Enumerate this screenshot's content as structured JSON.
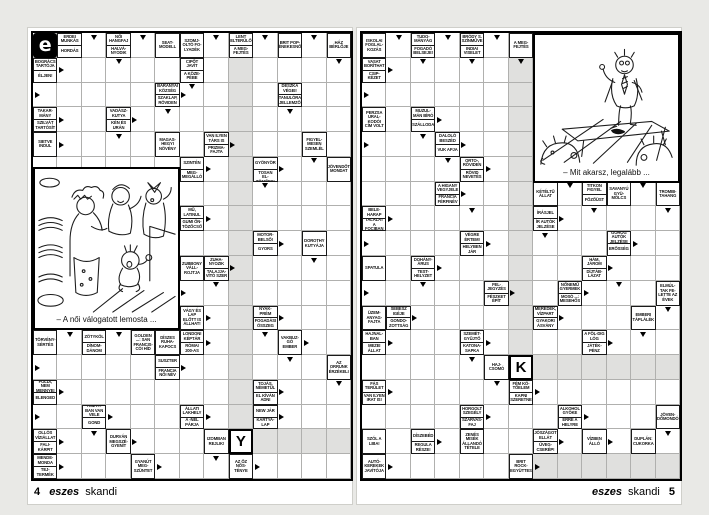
{
  "spread": {
    "background": "#e9e9e6",
    "page_color": "#ffffff",
    "grid_line_color": "#b0b0ae",
    "solution_shade_color": "#e0e0de",
    "ink_color": "#000000"
  },
  "left_page": {
    "logo_letter": "e",
    "footer": {
      "page_number": "4",
      "brand": "eszes",
      "series": "skandi"
    },
    "cartoon_caption": "– A női válogatott lemosta ...",
    "grid": {
      "cols": 13,
      "rows": 18
    },
    "shaded": [
      {
        "c0": 8,
        "c1": 8,
        "r0": 1,
        "r1": 15
      },
      {
        "c0": 9,
        "c1": 12,
        "r0": 16,
        "r1": 16
      }
    ],
    "letters": [
      {
        "c": 8,
        "r": 16,
        "ch": "Y"
      }
    ],
    "clues": [
      {
        "c": 1,
        "r": 0,
        "t": [
          "ERDEI MUNKÁS",
          "HORDÁS"
        ]
      },
      {
        "c": 3,
        "r": 0,
        "t": [
          "NŐI HANGFAJ",
          "HALVÁ-NYODIK"
        ]
      },
      {
        "c": 5,
        "r": 0,
        "t": [
          "SEAT-MODELL"
        ]
      },
      {
        "c": 6,
        "r": 0,
        "t": [
          "SZOMJ-OLTÓ FO-LYADÉK"
        ]
      },
      {
        "c": 8,
        "r": 0,
        "t": [
          "LENT ELTERÜLŐ",
          "A MEG-FEJTÉS"
        ]
      },
      {
        "c": 10,
        "r": 0,
        "t": [
          "BRIT POP-ÉNEKESNŐ"
        ]
      },
      {
        "c": 12,
        "r": 0,
        "t": [
          "HÁZ BÉRLŐJE"
        ]
      },
      {
        "c": 0,
        "r": 1,
        "t": [
          "BOGRÁCS TARTÓJA",
          "ÉLJEN!"
        ]
      },
      {
        "c": 6,
        "r": 1,
        "t": [
          "CIPŐT JAVÍT",
          "A KÖZE-PÉBE"
        ]
      },
      {
        "c": 5,
        "r": 2,
        "t": [
          "BARANYAI KÖZSÉG",
          "SZAKLAP, RÖVIDEN"
        ]
      },
      {
        "c": 10,
        "r": 2,
        "t": [
          "DESZKA VÉGEI!",
          "TANULÓRA JELLEMZŐ"
        ]
      },
      {
        "c": 0,
        "r": 3,
        "t": [
          "TAKAR-MÁNY",
          "SZILVÁT TARTÓSÍT"
        ]
      },
      {
        "c": 3,
        "r": 3,
        "t": [
          "VADÁSZ-KUTYA",
          "KÉN ÉS URÁN"
        ]
      },
      {
        "c": 0,
        "r": 4,
        "t": [
          "SIETVE INDUL"
        ]
      },
      {
        "c": 5,
        "r": 4,
        "t": [
          "MAGAS-HEGYI NÖVÉNY"
        ]
      },
      {
        "c": 7,
        "r": 4,
        "t": [
          "VAN ILYEN TÁRS IS",
          "PRIZMA-FAJTA"
        ]
      },
      {
        "c": 11,
        "r": 4,
        "t": [
          "FIGYEL-MESEN SZEMLÉL"
        ]
      },
      {
        "c": 6,
        "r": 5,
        "t": [
          "SZINTÉN",
          "MEG-MEGÁLLÓ"
        ]
      },
      {
        "c": 9,
        "r": 5,
        "t": [
          "GYÖNYÖR",
          "FOKOZA-TOSAN EL-TÖMŐDIK"
        ]
      },
      {
        "c": 12,
        "r": 5,
        "t": [
          "JÖVENDŐT MONDAT"
        ]
      },
      {
        "c": 6,
        "r": 7,
        "t": [
          "MŰ, LATINUL",
          "GUMI ÖN-TÖZŐCSŐ"
        ]
      },
      {
        "c": 9,
        "r": 8,
        "t": [
          "MOTOR-BELSŐ!",
          "GYORS"
        ]
      },
      {
        "c": 11,
        "r": 8,
        "t": [
          "DOROTHY KUTYÁJA"
        ]
      },
      {
        "c": 6,
        "r": 9,
        "t": [
          "ZUBBONY VÁLL-ROJTJA"
        ]
      },
      {
        "c": 7,
        "r": 9,
        "t": [
          "ZUHA-NYOZIK",
          "TALAJJA-VÍTÓ SZER"
        ]
      },
      {
        "c": 6,
        "r": 11,
        "t": [
          "VÁGY ÉS LAP ELŐTT IS ÁLLHAT!"
        ]
      },
      {
        "c": 9,
        "r": 11,
        "t": [
          "NYAK-PRÉM",
          "FOGADÁSI ÖSSZEG"
        ]
      },
      {
        "c": 0,
        "r": 12,
        "t": [
          "TÖRVÉNY-SÉRTÉS"
        ]
      },
      {
        "c": 2,
        "r": 12,
        "t": [
          "ZÖTYKÖL",
          "DÍNOM-DÁNOM"
        ]
      },
      {
        "c": 4,
        "r": 12,
        "t": [
          "GOLDEN ...: SAN FRANCIS-CÓI HÍD"
        ]
      },
      {
        "c": 5,
        "r": 12,
        "t": [
          "DÍSZES RUHA-KAPOCS"
        ]
      },
      {
        "c": 6,
        "r": 12,
        "t": [
          "LONDONI KÉPTÁR",
          "RÓMAI 200-AS"
        ]
      },
      {
        "c": 10,
        "r": 12,
        "t": [
          "VAKBUZ-GÓ EMBER"
        ]
      },
      {
        "c": 5,
        "r": 13,
        "t": [
          "SUSZTER",
          "FRANCIA NŐI NÉV"
        ]
      },
      {
        "c": 12,
        "r": 13,
        "t": [
          "AZ ORRUNK ÉRZÉKELI"
        ]
      },
      {
        "c": 0,
        "r": 14,
        "t": [
          "FÖLDI, NEM MENNYEI",
          "ELENGED"
        ]
      },
      {
        "c": 9,
        "r": 14,
        "t": [
          "TOJÁS, NÉMETÜL",
          "EL KÍVÁN ADNI"
        ]
      },
      {
        "c": 2,
        "r": 15,
        "t": [
          "TISZTÁ-BAN VAN VELE",
          "GOND"
        ]
      },
      {
        "c": 6,
        "r": 15,
        "t": [
          "ÁLLATI LAKHELY",
          "A -NÉL PÁRJA"
        ]
      },
      {
        "c": 9,
        "r": 15,
        "t": [
          "NEW JÁR",
          "KÁRTYA-LAP"
        ]
      },
      {
        "c": 0,
        "r": 16,
        "t": [
          "OLLÓS VÍZIÁLLAT",
          "FALI-KÁRPIT"
        ]
      },
      {
        "c": 3,
        "r": 16,
        "t": [
          "DURVÁN MEGSZÉ-GYENÍT"
        ]
      },
      {
        "c": 7,
        "r": 16,
        "t": [
          "IZOMBAN REJLIK!"
        ]
      },
      {
        "c": 0,
        "r": 17,
        "t": [
          "MENDE-MONDA",
          "TEJ-TERMÉK"
        ]
      },
      {
        "c": 4,
        "r": 17,
        "t": [
          "GYANÚT MEG-SZÜNTET"
        ]
      },
      {
        "c": 8,
        "r": 17,
        "t": [
          "AZ ŐZ NŐS-TÉNYE"
        ]
      }
    ],
    "arrows": [
      {
        "c": 2,
        "r": 0,
        "d": "down"
      },
      {
        "c": 4,
        "r": 0,
        "d": "down"
      },
      {
        "c": 7,
        "r": 0,
        "d": "down"
      },
      {
        "c": 9,
        "r": 0,
        "d": "down"
      },
      {
        "c": 11,
        "r": 0,
        "d": "down"
      },
      {
        "c": 3,
        "r": 1,
        "d": "down"
      },
      {
        "c": 12,
        "r": 1,
        "d": "down"
      },
      {
        "c": 1,
        "r": 1,
        "d": "right"
      },
      {
        "c": 0,
        "r": 2,
        "d": "right"
      },
      {
        "c": 6,
        "r": 2,
        "d": "right"
      },
      {
        "c": 6,
        "r": 2,
        "d": "down"
      },
      {
        "c": 1,
        "r": 3,
        "d": "right"
      },
      {
        "c": 4,
        "r": 3,
        "d": "right"
      },
      {
        "c": 5,
        "r": 3,
        "d": "down"
      },
      {
        "c": 10,
        "r": 3,
        "d": "down"
      },
      {
        "c": 1,
        "r": 4,
        "d": "right"
      },
      {
        "c": 3,
        "r": 4,
        "d": "down"
      },
      {
        "c": 8,
        "r": 4,
        "d": "right"
      },
      {
        "c": 7,
        "r": 5,
        "d": "right"
      },
      {
        "c": 10,
        "r": 5,
        "d": "right"
      },
      {
        "c": 11,
        "r": 5,
        "d": "down"
      },
      {
        "c": 9,
        "r": 6,
        "d": "down"
      },
      {
        "c": 7,
        "r": 7,
        "d": "right"
      },
      {
        "c": 10,
        "r": 8,
        "d": "right"
      },
      {
        "c": 8,
        "r": 9,
        "d": "right"
      },
      {
        "c": 11,
        "r": 9,
        "d": "down"
      },
      {
        "c": 6,
        "r": 10,
        "d": "right"
      },
      {
        "c": 7,
        "r": 10,
        "d": "down"
      },
      {
        "c": 7,
        "r": 11,
        "d": "right"
      },
      {
        "c": 10,
        "r": 11,
        "d": "right"
      },
      {
        "c": 1,
        "r": 12,
        "d": "down"
      },
      {
        "c": 3,
        "r": 12,
        "d": "down"
      },
      {
        "c": 7,
        "r": 12,
        "d": "right"
      },
      {
        "c": 9,
        "r": 12,
        "d": "down"
      },
      {
        "c": 11,
        "r": 12,
        "d": "right"
      },
      {
        "c": 0,
        "r": 13,
        "d": "right"
      },
      {
        "c": 6,
        "r": 13,
        "d": "right"
      },
      {
        "c": 10,
        "r": 13,
        "d": "down"
      },
      {
        "c": 1,
        "r": 14,
        "d": "right"
      },
      {
        "c": 10,
        "r": 14,
        "d": "right"
      },
      {
        "c": 12,
        "r": 14,
        "d": "down"
      },
      {
        "c": 0,
        "r": 15,
        "d": "right"
      },
      {
        "c": 3,
        "r": 15,
        "d": "right"
      },
      {
        "c": 7,
        "r": 15,
        "d": "right"
      },
      {
        "c": 10,
        "r": 15,
        "d": "right"
      },
      {
        "c": 1,
        "r": 16,
        "d": "right"
      },
      {
        "c": 2,
        "r": 16,
        "d": "down"
      },
      {
        "c": 4,
        "r": 16,
        "d": "right"
      },
      {
        "c": 1,
        "r": 17,
        "d": "right"
      },
      {
        "c": 5,
        "r": 17,
        "d": "right"
      },
      {
        "c": 7,
        "r": 17,
        "d": "down"
      },
      {
        "c": 9,
        "r": 17,
        "d": "right"
      }
    ]
  },
  "right_page": {
    "footer": {
      "page_number": "5",
      "brand": "eszes",
      "series": "skandi"
    },
    "cartoon_caption": "– Mit akarsz, legalább ...",
    "grid": {
      "cols": 13,
      "rows": 18
    },
    "shaded": [
      {
        "c0": 6,
        "c1": 6,
        "r0": 1,
        "r1": 12
      },
      {
        "c0": 7,
        "c1": 12,
        "r0": 13,
        "r1": 13
      },
      {
        "c0": 7,
        "c1": 12,
        "r0": 17,
        "r1": 17
      }
    ],
    "letters": [
      {
        "c": 6,
        "r": 13,
        "ch": "K"
      }
    ],
    "clues": [
      {
        "c": 0,
        "r": 0,
        "t": [
          "ISKOLAI FOGLAL-KOZÁS"
        ]
      },
      {
        "c": 2,
        "r": 0,
        "t": [
          "TUDO-MÁNYÁG",
          "FOGADÓ BELSEJE!"
        ]
      },
      {
        "c": 4,
        "r": 0,
        "t": [
          "BRÓDY S. SZÍNMŰVE",
          "INDIAI VISELET"
        ]
      },
      {
        "c": 6,
        "r": 0,
        "t": [
          "A MEG-FEJTÉS"
        ]
      },
      {
        "c": 0,
        "r": 1,
        "t": [
          "VASAT BORÍTHAT",
          "CSIP-KÉZET"
        ]
      },
      {
        "c": 0,
        "r": 3,
        "t": [
          "PERZSA URAL-KODÓI CÍM VOLT"
        ]
      },
      {
        "c": 2,
        "r": 3,
        "t": [
          "MUZUL-MÁN BÍRÓ",
          "SZÁLLODA"
        ]
      },
      {
        "c": 3,
        "r": 4,
        "t": [
          "DALOLÓ BESZÉD",
          "VUK APJA"
        ]
      },
      {
        "c": 4,
        "r": 5,
        "t": [
          "ORTO-, RÖVIDEN",
          "RÖVID NEVETÉS"
        ]
      },
      {
        "c": 3,
        "r": 6,
        "t": [
          "A HIGANY VEGYJELE",
          "FRANCIA FÉRFINÉV"
        ]
      },
      {
        "c": 7,
        "r": 6,
        "t": [
          "KÉTÉLTŰ ÁLLAT"
        ]
      },
      {
        "c": 9,
        "r": 6,
        "t": [
          "TITKON FIGYEL",
          "FŐZŐÜST"
        ]
      },
      {
        "c": 10,
        "r": 6,
        "t": [
          "SAVANYÚ GYÜ-MÖLCS"
        ]
      },
      {
        "c": 12,
        "r": 6,
        "t": [
          "TROMBI-TAHANG"
        ]
      },
      {
        "c": 0,
        "r": 7,
        "t": [
          "BELE-HARAP",
          "TALÁLAT A FOCIBAN"
        ]
      },
      {
        "c": 7,
        "r": 7,
        "t": [
          "ÍRÁSJEL",
          "ÍR AUTÓK JELZÉSE"
        ]
      },
      {
        "c": 4,
        "r": 8,
        "t": [
          "VÉGRE ÉRTEM!",
          "HELYBEN JÁR"
        ]
      },
      {
        "c": 10,
        "r": 8,
        "t": [
          "GÖRÖG AUTÓK JELZÉSE",
          "ERŐSSÉG"
        ]
      },
      {
        "c": 0,
        "r": 9,
        "t": [
          "SPATULA"
        ]
      },
      {
        "c": 2,
        "r": 9,
        "t": [
          "DOHÁNY-ÁRUS",
          "TEST-HELYZET"
        ]
      },
      {
        "c": 9,
        "r": 9,
        "t": [
          "HÁM, JÁROM",
          "DÍJTÁB-LÁZAT"
        ]
      },
      {
        "c": 5,
        "r": 10,
        "t": [
          "FEL-JEGYZÉS",
          "FÉSZKET ÉPÍT"
        ]
      },
      {
        "c": 8,
        "r": 10,
        "t": [
          "NŐNEMŰ GYERMEK",
          "MOSÓ ...: MESEHŐS"
        ]
      },
      {
        "c": 12,
        "r": 10,
        "t": [
          "ELMÚL-TAK FE-LETTE AZ ÉVEK"
        ]
      },
      {
        "c": 0,
        "r": 11,
        "t": [
          "ÜZEM-ANYAG-FAJTA"
        ]
      },
      {
        "c": 1,
        "r": 11,
        "t": [
          "SEBÉSZ IGÉJE",
          "GONDO-ZOTTSÁG"
        ]
      },
      {
        "c": 7,
        "r": 11,
        "t": [
          "MEREDEK, VÍZPART",
          "GYAKORI ÁSVÁNY"
        ]
      },
      {
        "c": 11,
        "r": 11,
        "t": [
          "EMBERI TÁPLÁLÉK"
        ]
      },
      {
        "c": 0,
        "r": 12,
        "t": [
          "HAJNAL-BAN",
          "MEZEI ÁLLAT"
        ]
      },
      {
        "c": 4,
        "r": 12,
        "t": [
          "SZEMÉT-GYŰJTŐ",
          "KATONA-SAPKA"
        ]
      },
      {
        "c": 9,
        "r": 12,
        "t": [
          "A FÖL-DIG LÓG",
          "JÁTÉK-PÉNZ"
        ]
      },
      {
        "c": 5,
        "r": 13,
        "t": [
          "HAJ-CSOMÓ"
        ]
      },
      {
        "c": 0,
        "r": 14,
        "t": [
          "FÁS TERÜLET",
          "VAN ILYEN IRAT IS!"
        ]
      },
      {
        "c": 6,
        "r": 14,
        "t": [
          "FÉM KÖ-TŐELEM",
          "KAPNI SZERETNE"
        ]
      },
      {
        "c": 4,
        "r": 15,
        "t": [
          "HORGOLT SZEGÉLY",
          "SZARVAS-FAJ"
        ]
      },
      {
        "c": 8,
        "r": 15,
        "t": [
          "ALKOHOL GYÖKE",
          "ERRE A HELYRE"
        ]
      },
      {
        "c": 12,
        "r": 15,
        "t": [
          "JÖVEN-DŐMONDÓ"
        ]
      },
      {
        "c": 0,
        "r": 16,
        "t": [
          "SZÓL A LIBA!"
        ]
      },
      {
        "c": 2,
        "r": 16,
        "t": [
          "DÍSZEBÉD",
          "REGULA RÉSZE!"
        ]
      },
      {
        "c": 4,
        "r": 16,
        "t": [
          "ZENÉS MISÉK ÁLLANDÓ TÉTELE"
        ]
      },
      {
        "c": 7,
        "r": 16,
        "t": [
          "JÓSZÁGOT ELLÁT",
          "ÜVEG-CSERÉP!"
        ]
      },
      {
        "c": 9,
        "r": 16,
        "t": [
          "VÍZBEN ÁLLÓ"
        ]
      },
      {
        "c": 11,
        "r": 16,
        "t": [
          "DUPLÁN: CUKORKA"
        ]
      },
      {
        "c": 0,
        "r": 17,
        "t": [
          "AUTÓ-KEREKEK JAVÍTÓJA"
        ]
      },
      {
        "c": 6,
        "r": 17,
        "t": [
          "BRIT ROCK-EGYÜTTES"
        ]
      }
    ],
    "arrows": [
      {
        "c": 1,
        "r": 0,
        "d": "down"
      },
      {
        "c": 3,
        "r": 0,
        "d": "down"
      },
      {
        "c": 5,
        "r": 0,
        "d": "down"
      },
      {
        "c": 1,
        "r": 1,
        "d": "right"
      },
      {
        "c": 2,
        "r": 1,
        "d": "down"
      },
      {
        "c": 4,
        "r": 1,
        "d": "down"
      },
      {
        "c": 6,
        "r": 1,
        "d": "down"
      },
      {
        "c": 0,
        "r": 2,
        "d": "right"
      },
      {
        "c": 3,
        "r": 3,
        "d": "right"
      },
      {
        "c": 0,
        "r": 4,
        "d": "right"
      },
      {
        "c": 2,
        "r": 4,
        "d": "down"
      },
      {
        "c": 4,
        "r": 4,
        "d": "right"
      },
      {
        "c": 3,
        "r": 5,
        "d": "down"
      },
      {
        "c": 5,
        "r": 5,
        "d": "right"
      },
      {
        "c": 4,
        "r": 6,
        "d": "right"
      },
      {
        "c": 8,
        "r": 6,
        "d": "down"
      },
      {
        "c": 11,
        "r": 6,
        "d": "down"
      },
      {
        "c": 1,
        "r": 7,
        "d": "right"
      },
      {
        "c": 4,
        "r": 7,
        "d": "down"
      },
      {
        "c": 8,
        "r": 7,
        "d": "right"
      },
      {
        "c": 9,
        "r": 7,
        "d": "down"
      },
      {
        "c": 12,
        "r": 7,
        "d": "down"
      },
      {
        "c": 0,
        "r": 8,
        "d": "right"
      },
      {
        "c": 5,
        "r": 8,
        "d": "right"
      },
      {
        "c": 7,
        "r": 8,
        "d": "down"
      },
      {
        "c": 11,
        "r": 8,
        "d": "right"
      },
      {
        "c": 3,
        "r": 9,
        "d": "right"
      },
      {
        "c": 10,
        "r": 9,
        "d": "right"
      },
      {
        "c": 0,
        "r": 10,
        "d": "right"
      },
      {
        "c": 2,
        "r": 10,
        "d": "down"
      },
      {
        "c": 6,
        "r": 10,
        "d": "right"
      },
      {
        "c": 9,
        "r": 10,
        "d": "right"
      },
      {
        "c": 10,
        "r": 10,
        "d": "down"
      },
      {
        "c": 2,
        "r": 11,
        "d": "right"
      },
      {
        "c": 8,
        "r": 11,
        "d": "right"
      },
      {
        "c": 12,
        "r": 11,
        "d": "down"
      },
      {
        "c": 1,
        "r": 12,
        "d": "right"
      },
      {
        "c": 5,
        "r": 12,
        "d": "right"
      },
      {
        "c": 10,
        "r": 12,
        "d": "right"
      },
      {
        "c": 11,
        "r": 12,
        "d": "down"
      },
      {
        "c": 4,
        "r": 13,
        "d": "down"
      },
      {
        "c": 1,
        "r": 14,
        "d": "right"
      },
      {
        "c": 5,
        "r": 14,
        "d": "down"
      },
      {
        "c": 7,
        "r": 14,
        "d": "right"
      },
      {
        "c": 5,
        "r": 15,
        "d": "right"
      },
      {
        "c": 9,
        "r": 15,
        "d": "right"
      },
      {
        "c": 3,
        "r": 16,
        "d": "right"
      },
      {
        "c": 8,
        "r": 16,
        "d": "right"
      },
      {
        "c": 10,
        "r": 16,
        "d": "right"
      },
      {
        "c": 12,
        "r": 16,
        "d": "down"
      },
      {
        "c": 1,
        "r": 17,
        "d": "right"
      },
      {
        "c": 7,
        "r": 17,
        "d": "right"
      }
    ]
  }
}
